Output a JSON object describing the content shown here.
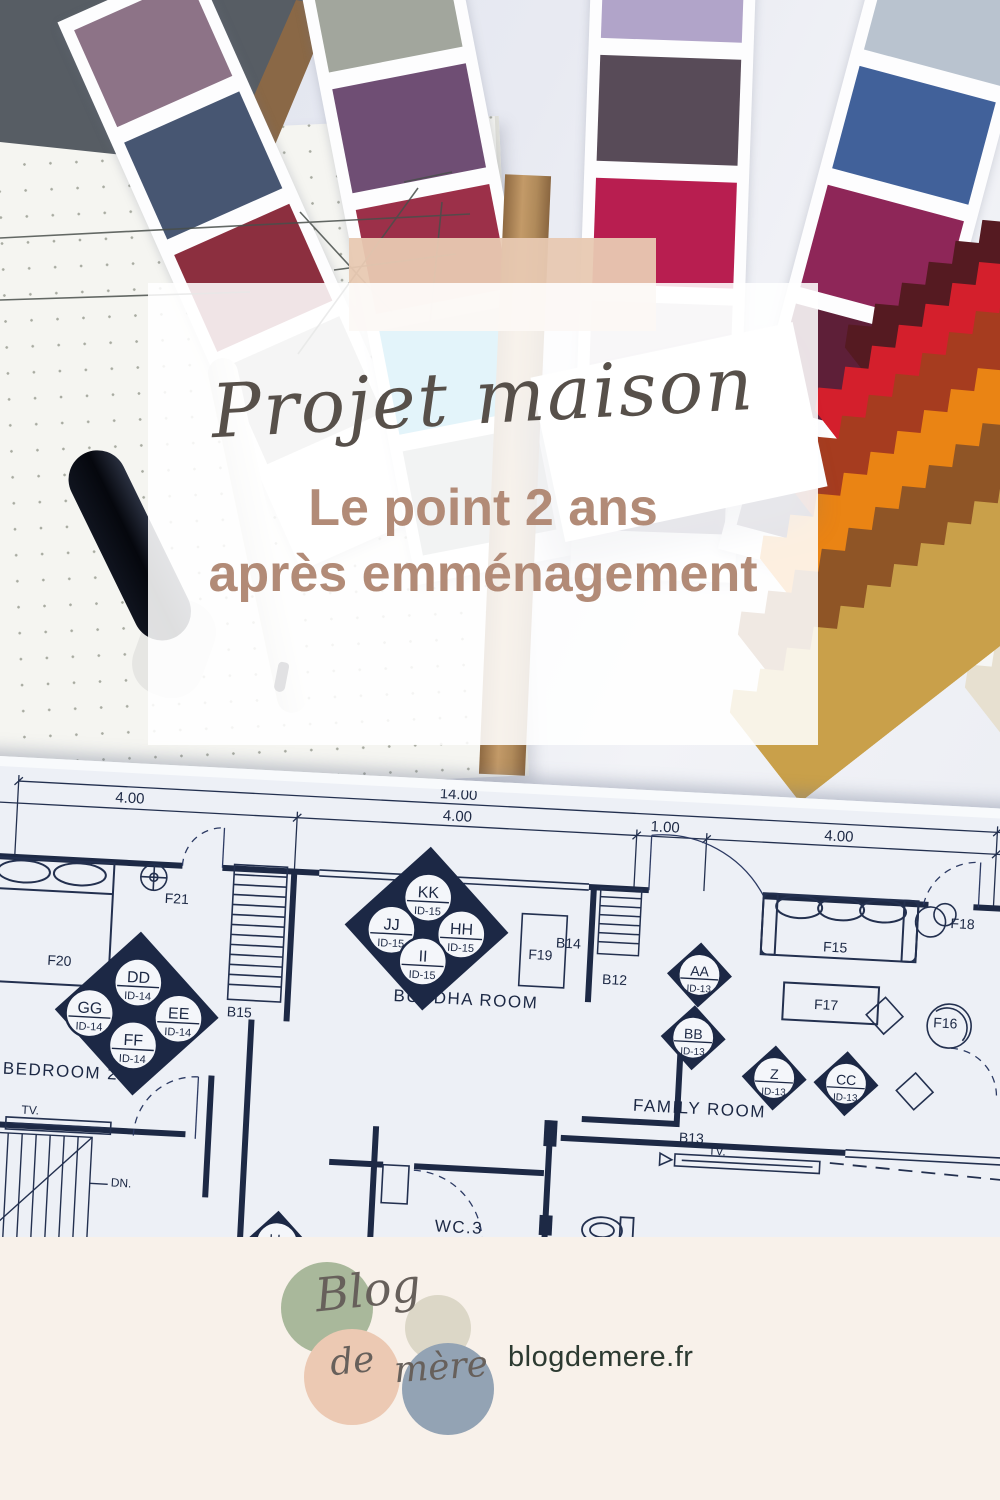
{
  "overlay": {
    "title": "Projet maison",
    "subtitle_line1": "Le point 2 ans",
    "subtitle_line2": "après emménagement",
    "title_color": "#57504a",
    "subtitle_color": "#b28b77",
    "accent_bar_color": "#e8c9b2"
  },
  "floor_plan": {
    "dims": {
      "total": "14.00",
      "seg1": "4.00",
      "seg2": "4.00",
      "seg3": "1.00",
      "seg4": "4.00"
    },
    "rooms": {
      "bedroom2": "BEDROOM 2",
      "buddha": "BUDDHA ROOM",
      "family": "FAMILY ROOM",
      "wc": "WC.3"
    },
    "fixtures": {
      "f20": "F20",
      "f21": "F21",
      "f19": "F19",
      "f15": "F15",
      "f16": "F16",
      "f17": "F17",
      "f18": "F18",
      "b12": "B12",
      "b13": "B13",
      "b14": "B14",
      "b15": "B15",
      "tv1": "TV.",
      "tv2": "TV.",
      "dn": "DN."
    },
    "markers": {
      "kk": {
        "code": "KK",
        "id": "ID-15"
      },
      "jj": {
        "code": "JJ",
        "id": "ID-15"
      },
      "hh": {
        "code": "HH",
        "id": "ID-15"
      },
      "ii": {
        "code": "II",
        "id": "ID-15"
      },
      "dd": {
        "code": "DD",
        "id": "ID-14"
      },
      "gg": {
        "code": "GG",
        "id": "ID-14"
      },
      "ee": {
        "code": "EE",
        "id": "ID-14"
      },
      "ff": {
        "code": "FF",
        "id": "ID-14"
      },
      "aa": {
        "code": "AA",
        "id": "ID-13"
      },
      "bb": {
        "code": "BB",
        "id": "ID-13"
      },
      "z": {
        "code": "Z",
        "id": "ID-13"
      },
      "cc": {
        "code": "CC",
        "id": "ID-13"
      },
      "ll": {
        "code": "LL",
        "id": "ID-1"
      }
    },
    "ink_color": "#23304f"
  },
  "footer": {
    "url": "blogdemere.fr",
    "logo": {
      "word1": "Blog",
      "word2": "de",
      "word3": "mère",
      "colors": {
        "green": "#a9b89b",
        "cream": "#dcd7c7",
        "peach": "#ecc9b3",
        "blue": "#93a3b4"
      }
    }
  },
  "photo": {
    "swatch_cards": [
      {
        "colors": [
          "#8d7387",
          "#475672",
          "#8c2f3f",
          "#b0b0ae"
        ]
      },
      {
        "colors": [
          "#a2a69d",
          "#6f4e74",
          "#9c3049",
          "#28a8d6",
          "#9aa0a0"
        ]
      },
      {
        "colors": [
          "#b1a4c9",
          "#584b58",
          "#b81e50",
          "#c5bec6",
          "#342c52"
        ]
      },
      {
        "colors": [
          "#b9c3cf",
          "#41619a",
          "#8e2658",
          "#5e1f38",
          "#3a3350"
        ]
      },
      {
        "colors": [
          "#ccd3d8",
          "#c41f3c",
          "#6b2233",
          "#4b1830"
        ]
      }
    ],
    "fabric_colors": [
      "#f6f6f4",
      "#e7e0d0",
      "#551a21",
      "#d41f2c",
      "#a63c1f",
      "#ea8414",
      "#8f5526",
      "#c9a04a"
    ]
  }
}
